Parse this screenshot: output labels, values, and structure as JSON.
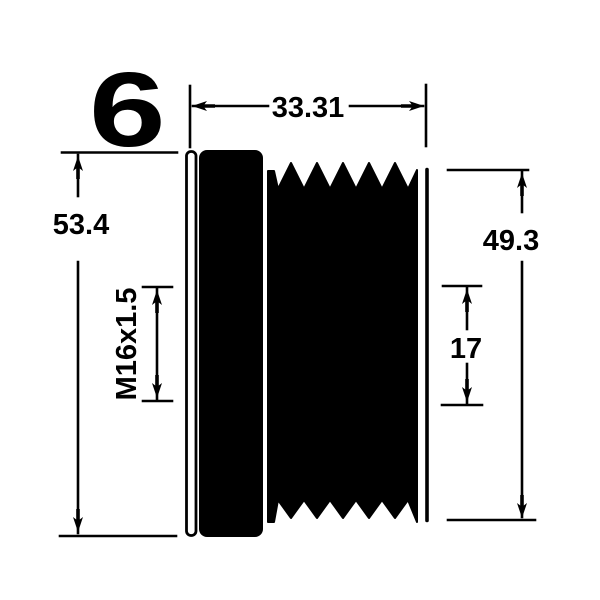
{
  "colors": {
    "ink": "#000000",
    "background": "#ffffff"
  },
  "drawing": {
    "rib_count": "6",
    "dimensions": {
      "width": "33.31",
      "outer_diameter": "53.4",
      "ribbed_diameter": "49.3",
      "inner_length": "17",
      "thread": "M16x1.5"
    }
  }
}
